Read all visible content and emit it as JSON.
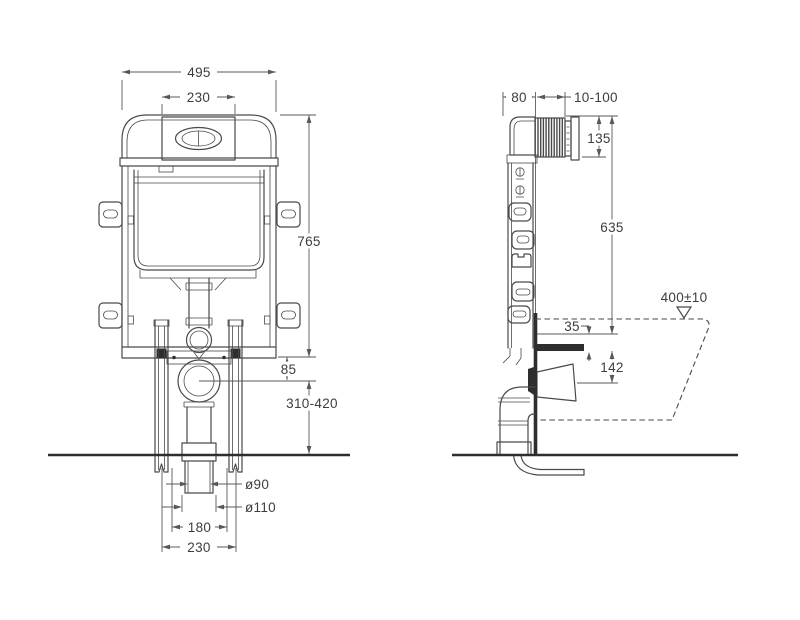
{
  "colors": {
    "background": "#ffffff",
    "line": "#4a4a4a",
    "dimension_line": "#585858",
    "text": "#3d3d3d",
    "dark_fill": "#2e2e2e"
  },
  "front_view": {
    "dims": {
      "overall_width": "495",
      "flush_plate_width": "230",
      "frame_height": "765",
      "outlet_offset": "85",
      "outlet_height_range": "310-420",
      "outlet_inner_dia": "ø90",
      "outlet_outer_dia": "ø110",
      "spacing_inner": "180",
      "spacing_outer": "230"
    }
  },
  "side_view": {
    "dims": {
      "frame_depth": "80",
      "plate_adjust_range": "10-100",
      "plate_height": "135",
      "cistern_height": "635",
      "pan_top_height": "400±10",
      "pipe_offset": "35",
      "outlet_drop": "142"
    }
  }
}
